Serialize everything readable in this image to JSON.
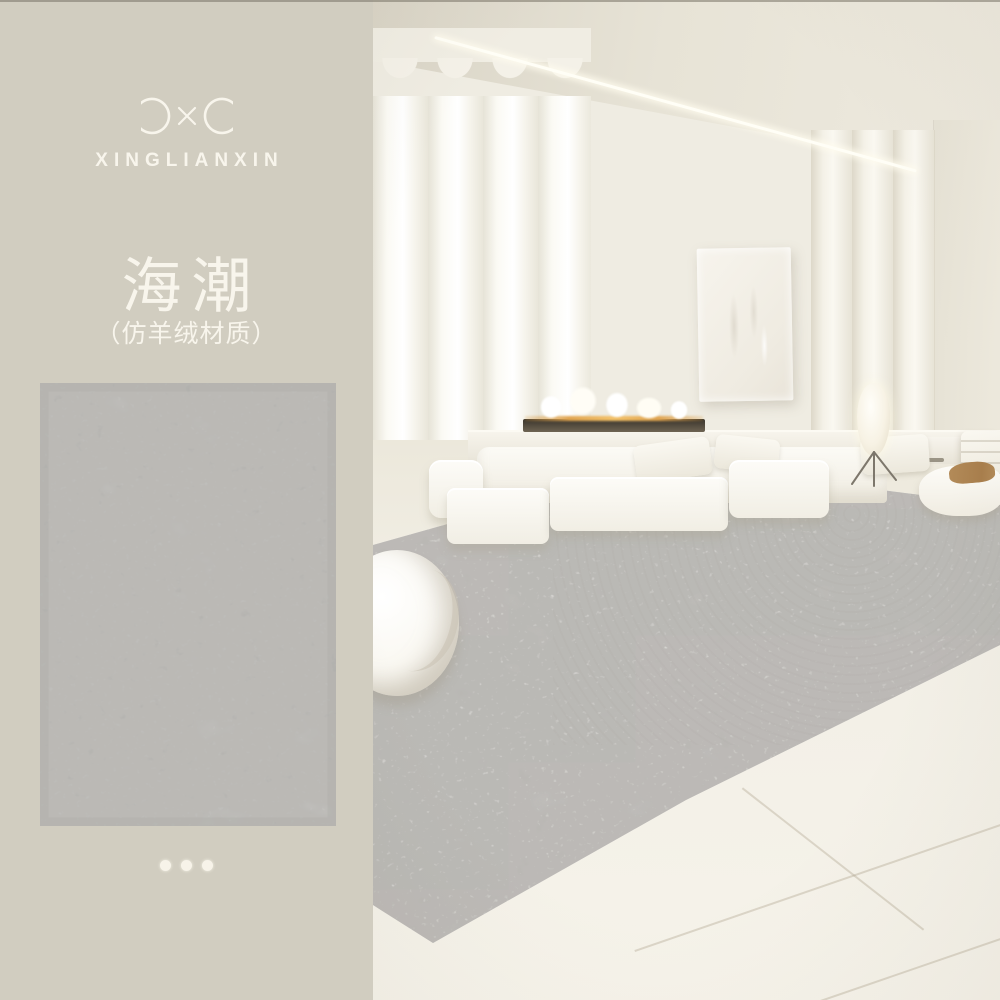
{
  "left_panel": {
    "brand": "XINGLIANXIN",
    "logo_icon": "infinity-loops-icon",
    "title": "海潮",
    "subtitle": "（仿羊绒材质）",
    "pagination": {
      "dot_count": 3
    }
  },
  "scene_labels": {
    "swatch": "rug-swatch-image",
    "room": "living-room-photo"
  },
  "colors": {
    "panel_bg": "#d1cdc0",
    "text_light": "#f8f5ec",
    "swatch_base": "#e4e3e0",
    "swatch_mottle": "#b0afac",
    "wall": "#efece2",
    "ceiling": "#e3ded1",
    "floor": "#f3f0e7",
    "rug_gray": "#dedcd8",
    "flame_glow": "#e0a44f",
    "blanket_tan": "#b38b59",
    "dot": "#f7f3e9"
  }
}
